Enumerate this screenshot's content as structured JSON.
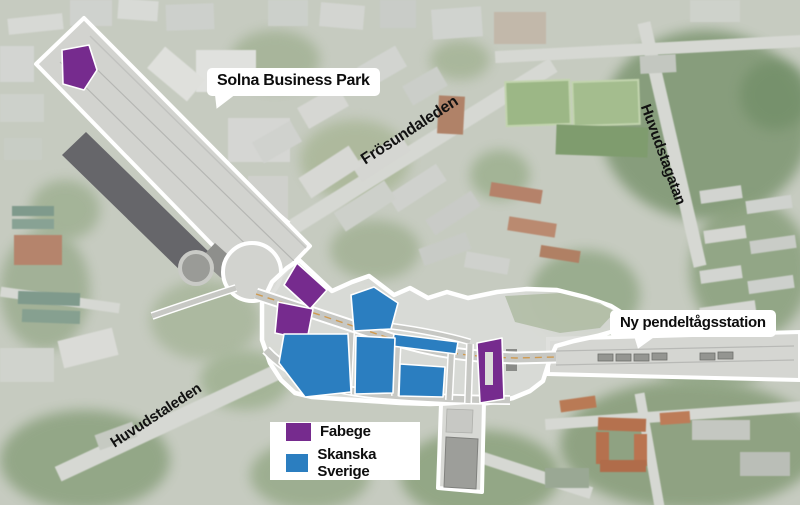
{
  "map": {
    "callouts": {
      "solna": "Solna Business Park",
      "station": "Ny pendeltågsstation"
    },
    "road_labels": {
      "frosundaleden": "Frösundaleden",
      "huvudstagatan": "Huvudstagatan",
      "huvudstaleden": "Huvudstaleden"
    },
    "legend": {
      "items": [
        {
          "label": "Fabege",
          "color": "#762b8e"
        },
        {
          "label": "Skanska Sverige",
          "color": "#2b7ec0"
        }
      ]
    }
  }
}
